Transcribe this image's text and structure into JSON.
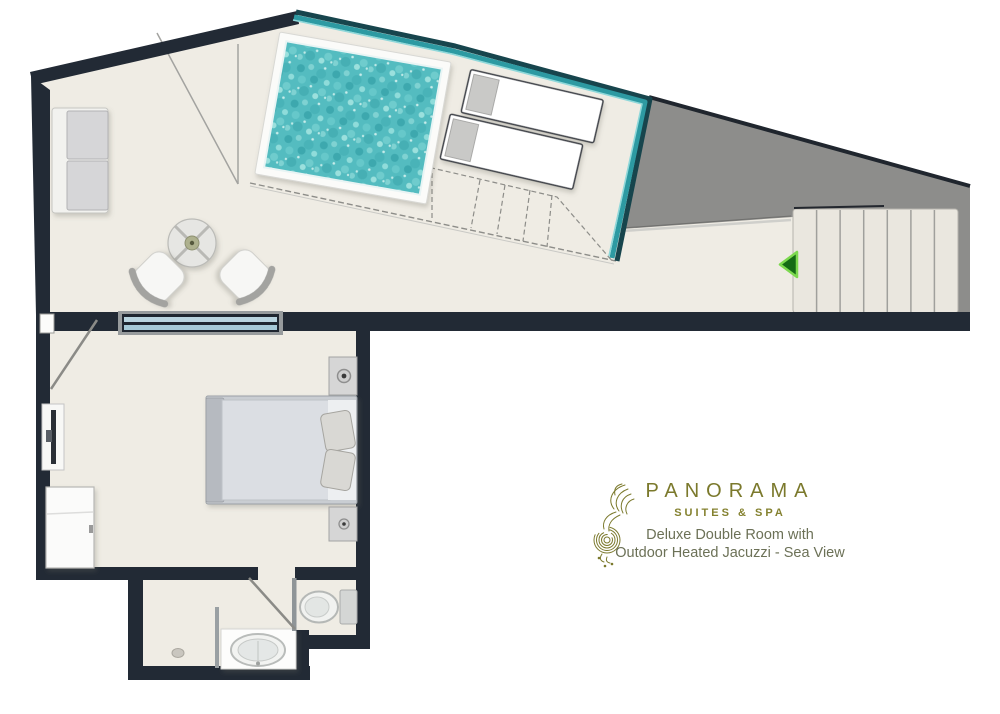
{
  "brand": {
    "name": "PANORAMA",
    "tagline": "SUITES & SPA"
  },
  "room": {
    "description_line1": "Deluxe Double Room with",
    "description_line2": "Outdoor Heated Jacuzzi - Sea View"
  },
  "floorplan": {
    "areas": [
      "terrace",
      "jacuzzi-pool",
      "bedroom",
      "bathroom",
      "toilet-compartment",
      "staircase"
    ],
    "staircase_treads": 7,
    "icons": {
      "entrance_arrow": "entrance-arrow-icon",
      "logo_mark": "seahorse-swirl-icon"
    }
  },
  "colors": {
    "wall_dark": "#222a35",
    "floor_beige": "#efece4",
    "pool_water_teal": "#54bcc0",
    "glass_balustrade_teal": "#2d9aa2",
    "roof_gray": "#8d8d8b",
    "brand_olive": "#7b792c",
    "entrance_arrow_green": "#156b15",
    "window_glass_blue": "#b5d3de"
  }
}
